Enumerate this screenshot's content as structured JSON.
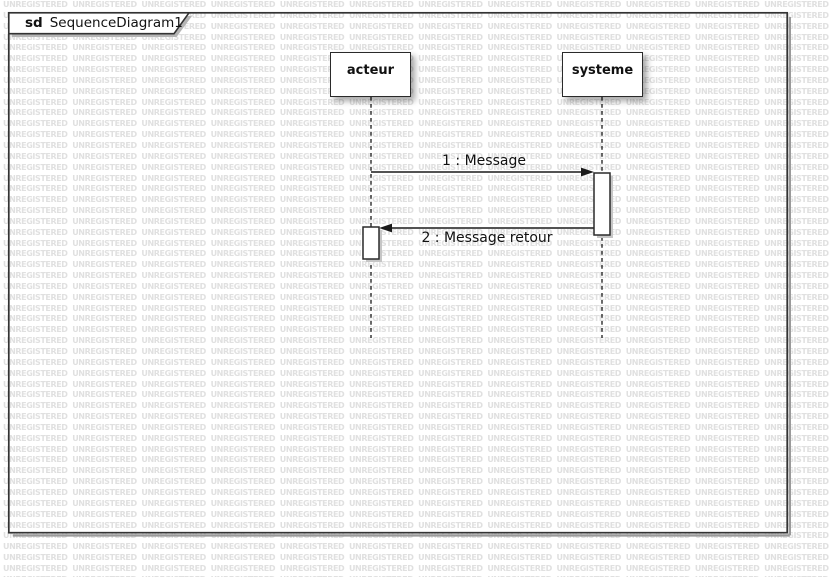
{
  "watermark": {
    "text": "UNREGISTERED",
    "color": "#e0e0e0"
  },
  "frame": {
    "keyword": "sd",
    "title": "SequenceDiagram1"
  },
  "lifelines": [
    {
      "name": "acteur"
    },
    {
      "name": "systeme"
    }
  ],
  "messages": [
    {
      "label": "1 : Message",
      "from": "acteur",
      "to": "systeme"
    },
    {
      "label": "2 : Message retour",
      "from": "systeme",
      "to": "acteur"
    }
  ],
  "colors": {
    "shape_border": "#2a2a2a",
    "shape_fill": "#ffffff",
    "text": "#111111",
    "watermark": "#e0e0e0",
    "shadow": "#b5b5b5"
  }
}
